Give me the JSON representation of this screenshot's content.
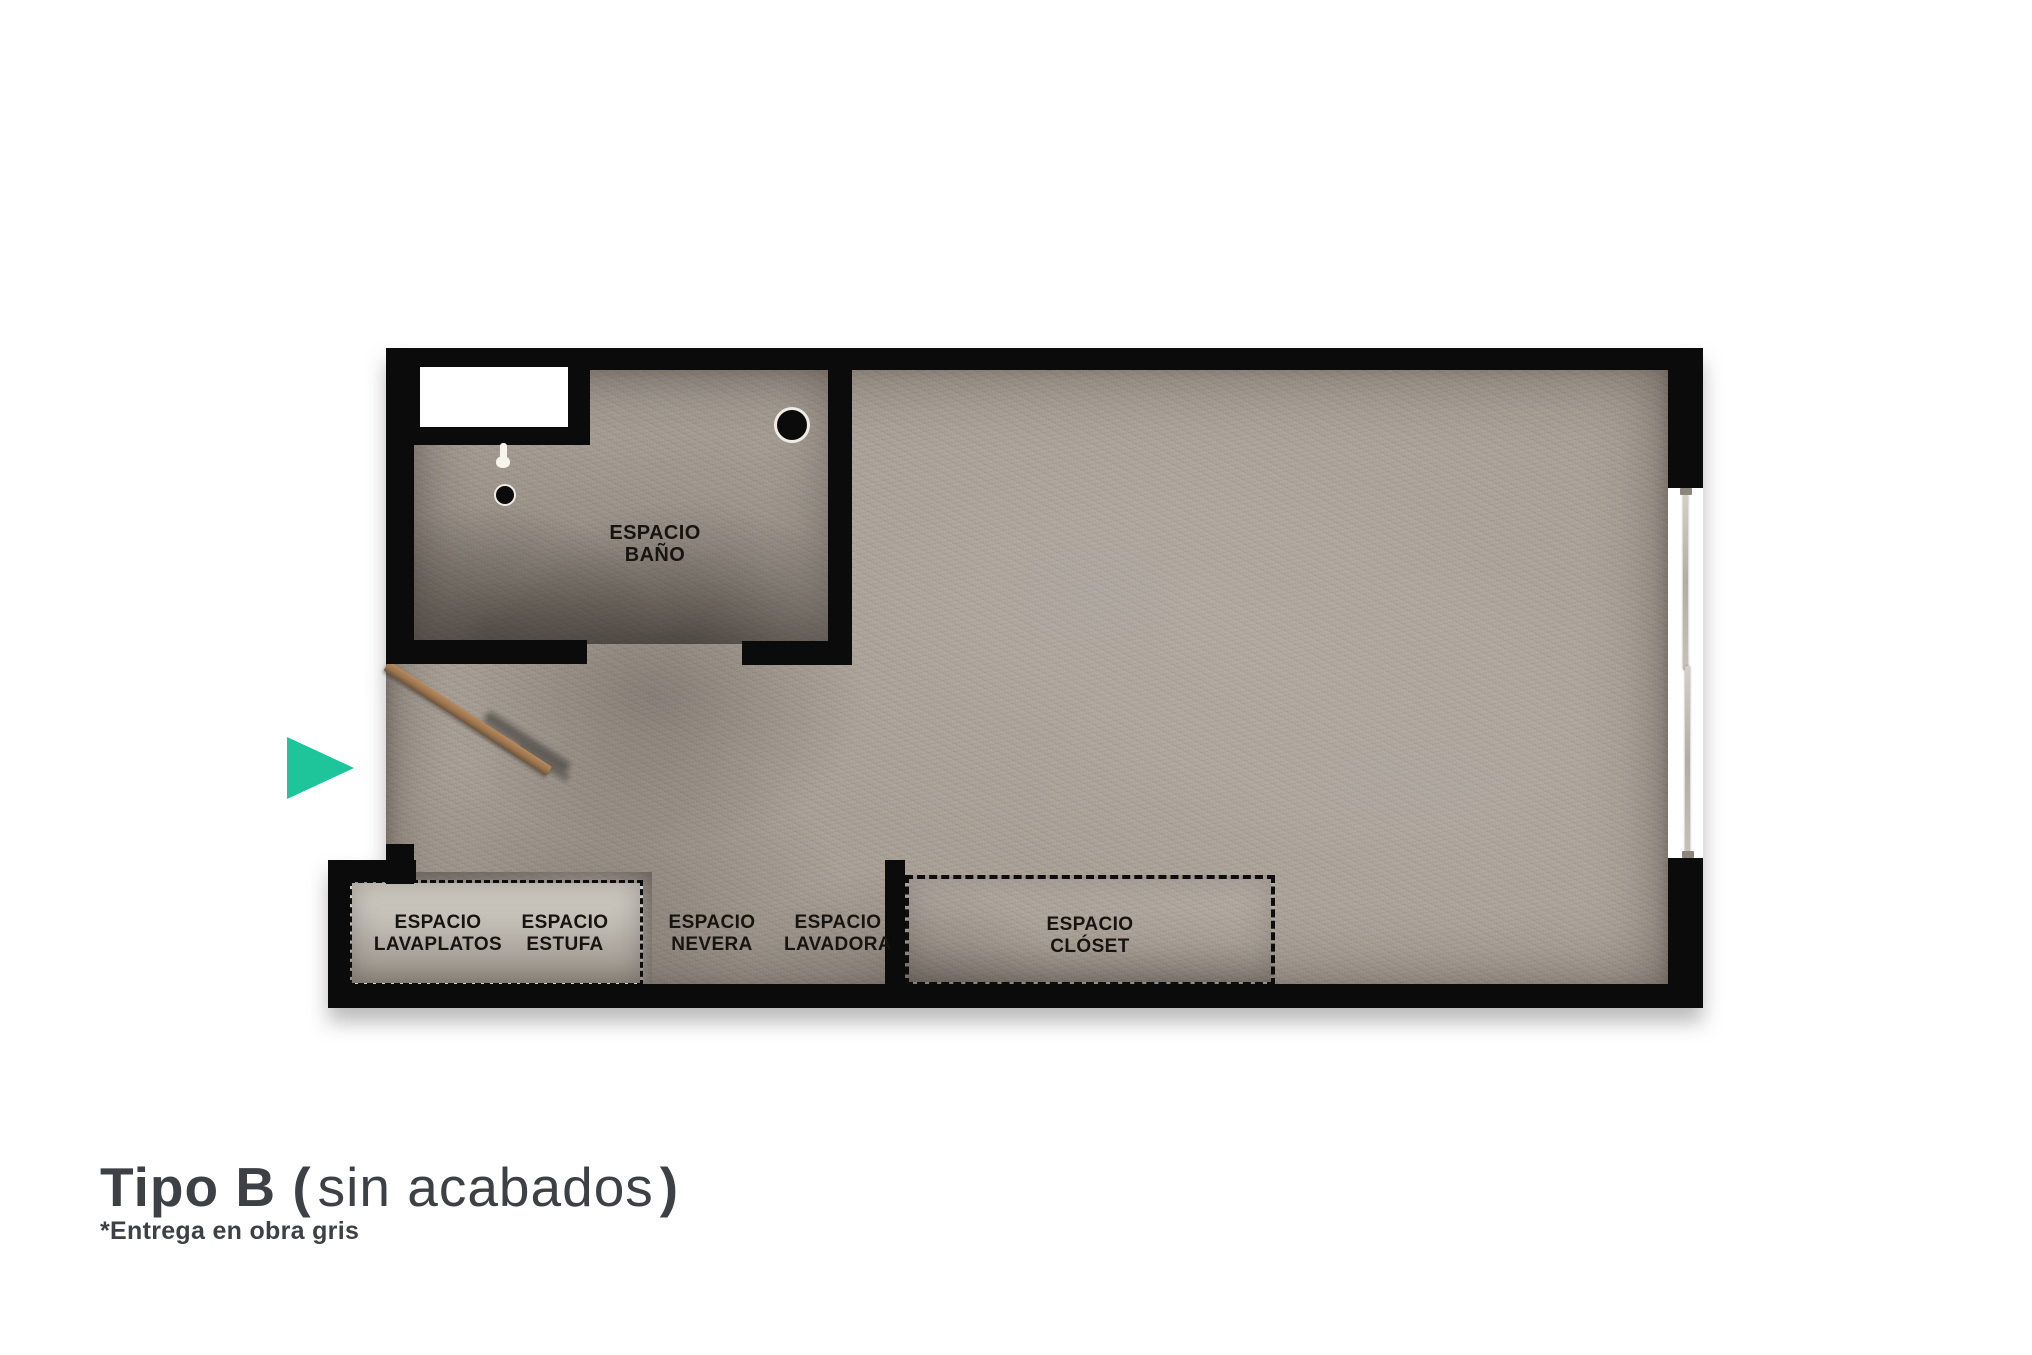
{
  "title": {
    "bold_open": "Tipo B (",
    "regular": "sin acabados",
    "bold_close": ")"
  },
  "subtitle": "*Entrega en obra gris",
  "floorplan": {
    "labels": {
      "bano": {
        "line1": "ESPACIO",
        "line2": "BAÑO"
      },
      "lavaplatos": {
        "line1": "ESPACIO",
        "line2": "LAVAPLATOS"
      },
      "estufa": {
        "line1": "ESPACIO",
        "line2": "ESTUFA"
      },
      "nevera": {
        "line1": "ESPACIO",
        "line2": "NEVERA"
      },
      "lavadora": {
        "line1": "ESPACIO",
        "line2": "LAVADORA"
      },
      "closet": {
        "line1": "ESPACIO",
        "line2": "CLÓSET"
      }
    },
    "colors": {
      "wall": "#0b0b0b",
      "floor_concrete": "#a89f95",
      "counter_fill": "#c6c1b9",
      "entrance_arrow": "#1ec49a",
      "door_wood": "#9a7450",
      "window_frame": "#b9b2a8",
      "title_text": "#3d4045",
      "label_text": "#17140f"
    }
  }
}
